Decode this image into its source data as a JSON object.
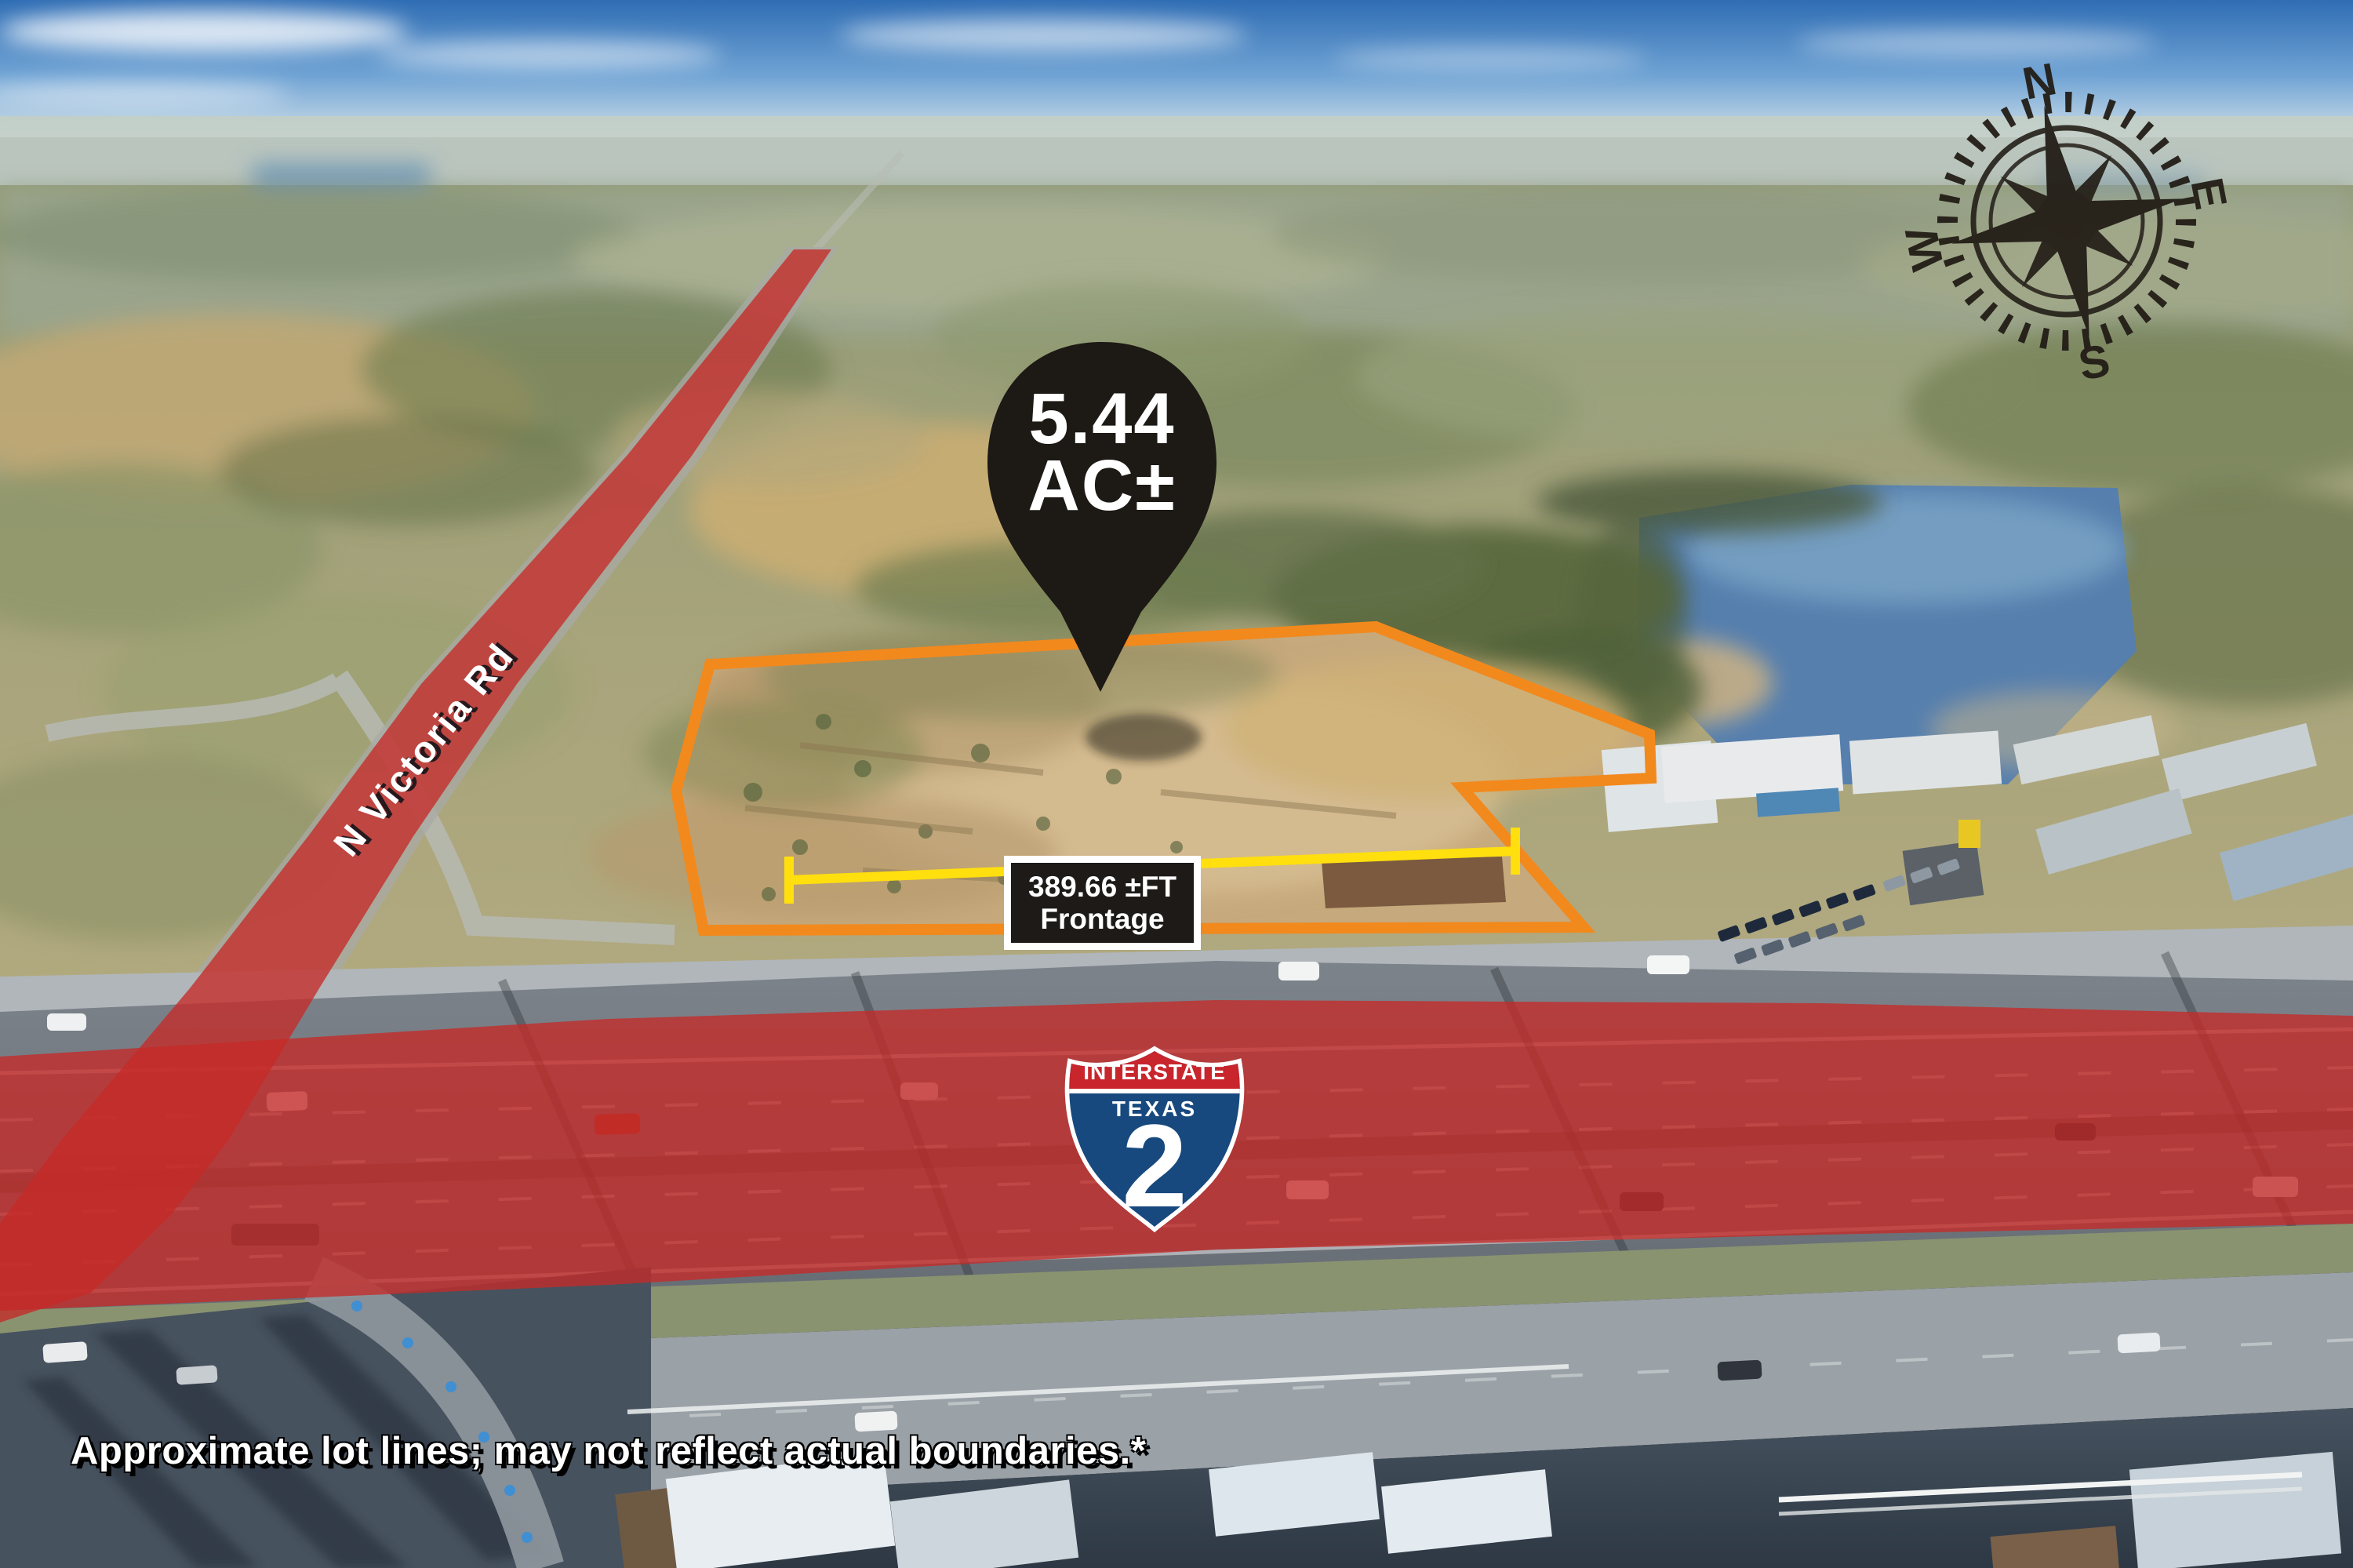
{
  "marker": {
    "area_value": "5.44",
    "area_unit": "AC±"
  },
  "frontage": {
    "line1": "389.66 ±FT",
    "line2": "Frontage"
  },
  "roads": {
    "victoria_label": "N Victoria Rd"
  },
  "shield": {
    "top": "INTERSTATE",
    "state": "TEXAS",
    "number": "2"
  },
  "compass": {
    "north": "N",
    "east": "E",
    "south": "S",
    "west": "W"
  },
  "disclaimer": "Approximate lot lines; may not reflect actual boundaries.*",
  "colors": {
    "boundary_orange": "#f2891d",
    "frontage_yellow": "#ffdf0e",
    "overlay_red": "#c52a28",
    "pin_black": "#1d1915",
    "compass_black": "#211c16",
    "shield_blue": "#17497f",
    "shield_red": "#c8252c",
    "shield_white": "#ffffff"
  }
}
